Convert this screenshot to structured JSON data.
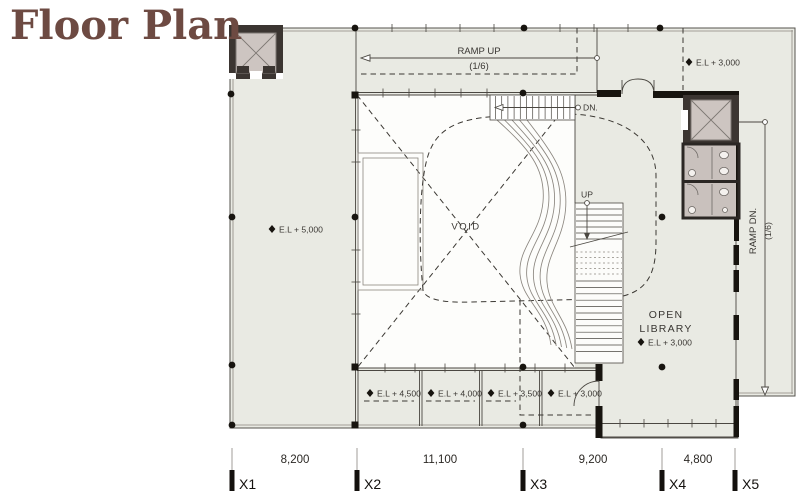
{
  "title": "Floor Plan",
  "colors": {
    "accent_brown": "#6d4a42",
    "floor_fill": "#e9eae3",
    "wall_dark": "#2b2724",
    "shaft_fill": "#cdc5c1",
    "line": "#4a4741"
  },
  "plan": {
    "ramp_up_label": "RAMP UP",
    "ramp_up_slope": "(1/6)",
    "ramp_dn_label": "RAMP DN.",
    "ramp_dn_slope": "(1/6)",
    "stairs_dn_label": "DN.",
    "stairs_up_label": "UP",
    "void_label": "VOID",
    "level_left": "E.L + 5,000",
    "level_top_right": "E.L + 3,000",
    "open_library": {
      "line1": "OPEN",
      "line2": "LIBRARY",
      "level": "E.L + 3,000"
    },
    "ramp_levels": [
      "E.L + 4,500",
      "E.L + 4,000",
      "E.L + 3,500",
      "E.L + 3,000"
    ]
  },
  "dimensions": {
    "axes": [
      "X1",
      "X2",
      "X3",
      "X4",
      "X5"
    ],
    "spans": [
      "8,200",
      "11,100",
      "9,200",
      "4,800"
    ]
  }
}
